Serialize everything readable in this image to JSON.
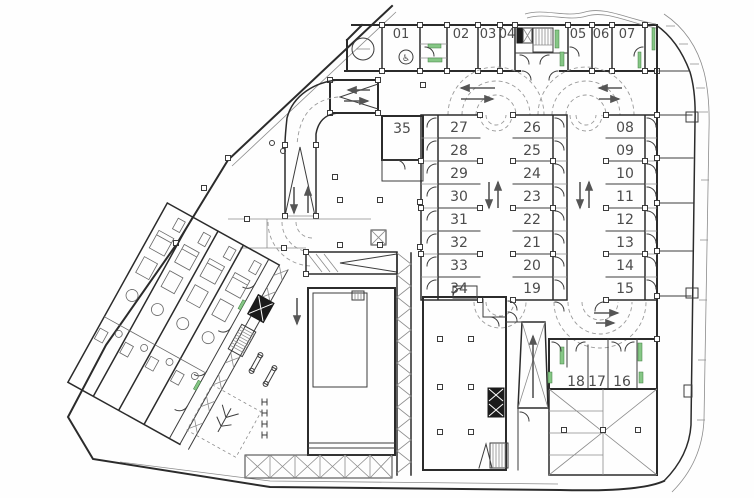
{
  "colors": {
    "paper": "#fefefe",
    "wall": "#2b2b2b",
    "line": "#3c3c3c",
    "thin": "#8c8c8c",
    "dashed": "#9a9a9a",
    "arrow": "#555555",
    "green": "#86c786",
    "label": "#4c4c4c",
    "dark": "#1b1b1b"
  },
  "stalls": {
    "top_row": [
      "01",
      "02",
      "03",
      "04",
      "05",
      "06",
      "07"
    ],
    "col_a": [
      "27",
      "28",
      "29",
      "30",
      "31",
      "32",
      "33",
      "34"
    ],
    "col_b": [
      "26",
      "25",
      "24",
      "23",
      "22",
      "21",
      "20",
      "19"
    ],
    "col_c": [
      "08",
      "09",
      "10",
      "11",
      "12",
      "13",
      "14",
      "15"
    ],
    "bottom_row": [
      "18",
      "17",
      "16"
    ],
    "wide_stall": "35"
  },
  "icons": {
    "accessible_parking": "♿"
  }
}
